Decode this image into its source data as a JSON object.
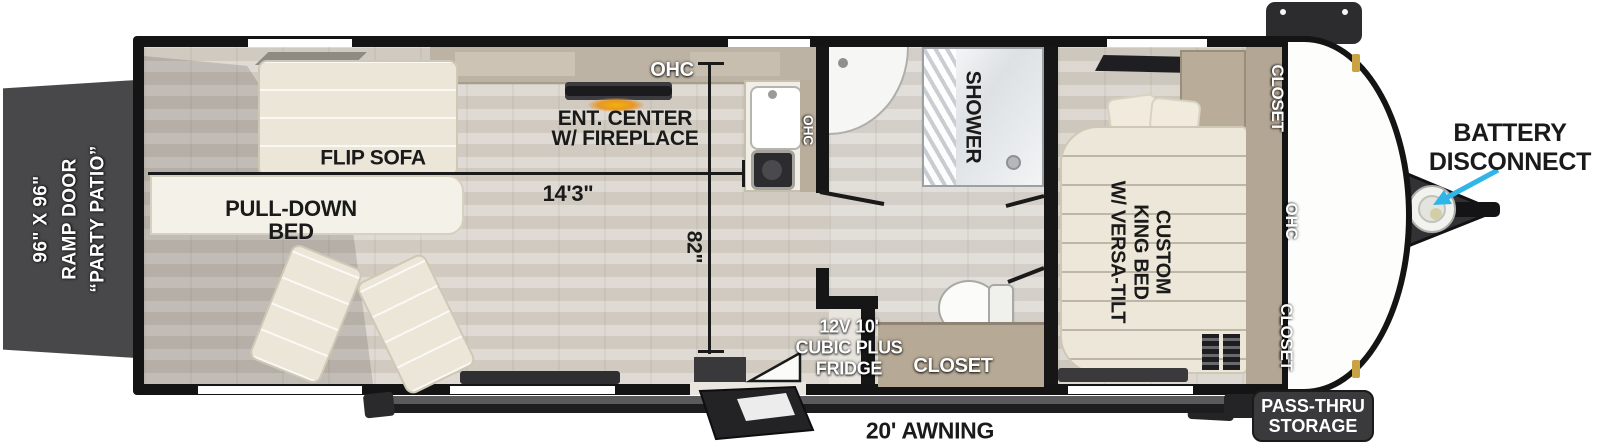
{
  "ramp_door": {
    "lines": [
      "96\" X 96\"",
      "RAMP DOOR",
      "“PARTY PATIO”"
    ]
  },
  "garage": {
    "flip_sofa_label": "FLIP SOFA",
    "pull_down_bed_lines": [
      "PULL-DOWN",
      "BED"
    ],
    "ent_center_lines": [
      "ENT. CENTER",
      "W/ FIREPLACE"
    ],
    "ohc_label": "OHC",
    "kitchen_ohc_label": "OHC"
  },
  "dimensions": {
    "garage_length": "14'3\"",
    "interior_width": "82\""
  },
  "bathroom": {
    "shower_label": "SHOWER",
    "closet_label": "CLOSET",
    "fridge_lines": [
      "12V 10'",
      "CUBIC PLUS",
      "FRIDGE"
    ]
  },
  "bedroom": {
    "bed_lines": [
      "CUSTOM",
      "KING BED",
      "W/ VERSA-TILT"
    ],
    "front_closet_top": "CLOSET",
    "front_ohc": "OHC",
    "front_closet_bottom": "CLOSET"
  },
  "exterior": {
    "awning_label": "20' AWNING",
    "pass_thru_lines": [
      "PASS-THRU",
      "STORAGE"
    ],
    "battery_lines": [
      "BATTERY",
      "DISCONNECT"
    ]
  },
  "colors": {
    "arrow_accent": "#2fb5e8",
    "wall": "#161616",
    "ramp_door": "#48484a",
    "closet_tan": "#b3a694",
    "awning_dark": "#1d1d1f"
  }
}
